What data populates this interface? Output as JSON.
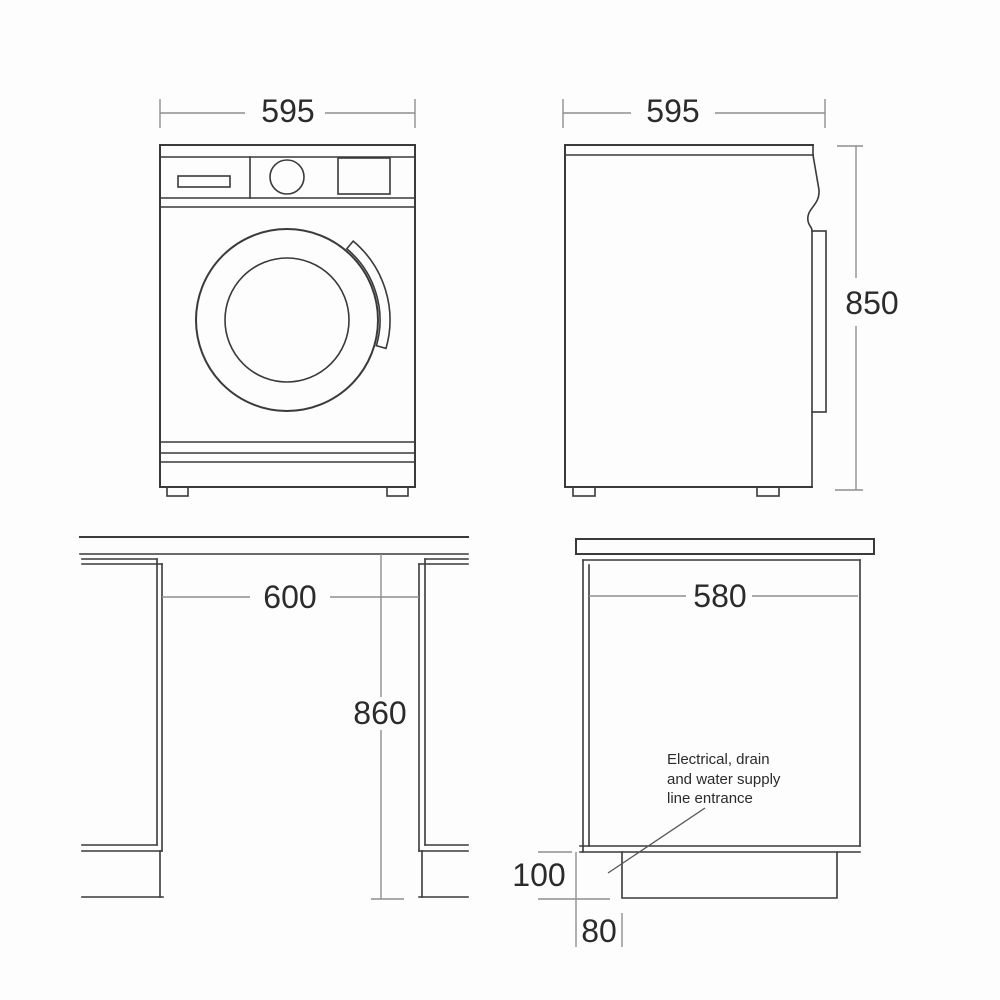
{
  "colors": {
    "background": "#fdfdfd",
    "object_line": "#3a3a3a",
    "dimension_line": "#8f8f8f",
    "label_text": "#2b2b2b"
  },
  "views": {
    "front": {
      "width_label": "595"
    },
    "side": {
      "depth_label": "595",
      "height_label": "850"
    },
    "niche_front": {
      "width_label": "600",
      "height_label": "860"
    },
    "niche_side": {
      "depth_label": "580",
      "plinth_height_label": "100",
      "plinth_recess_label": "80",
      "annotation_line1": "Electrical, drain",
      "annotation_line2": "and water supply",
      "annotation_line3": "line entrance"
    }
  }
}
